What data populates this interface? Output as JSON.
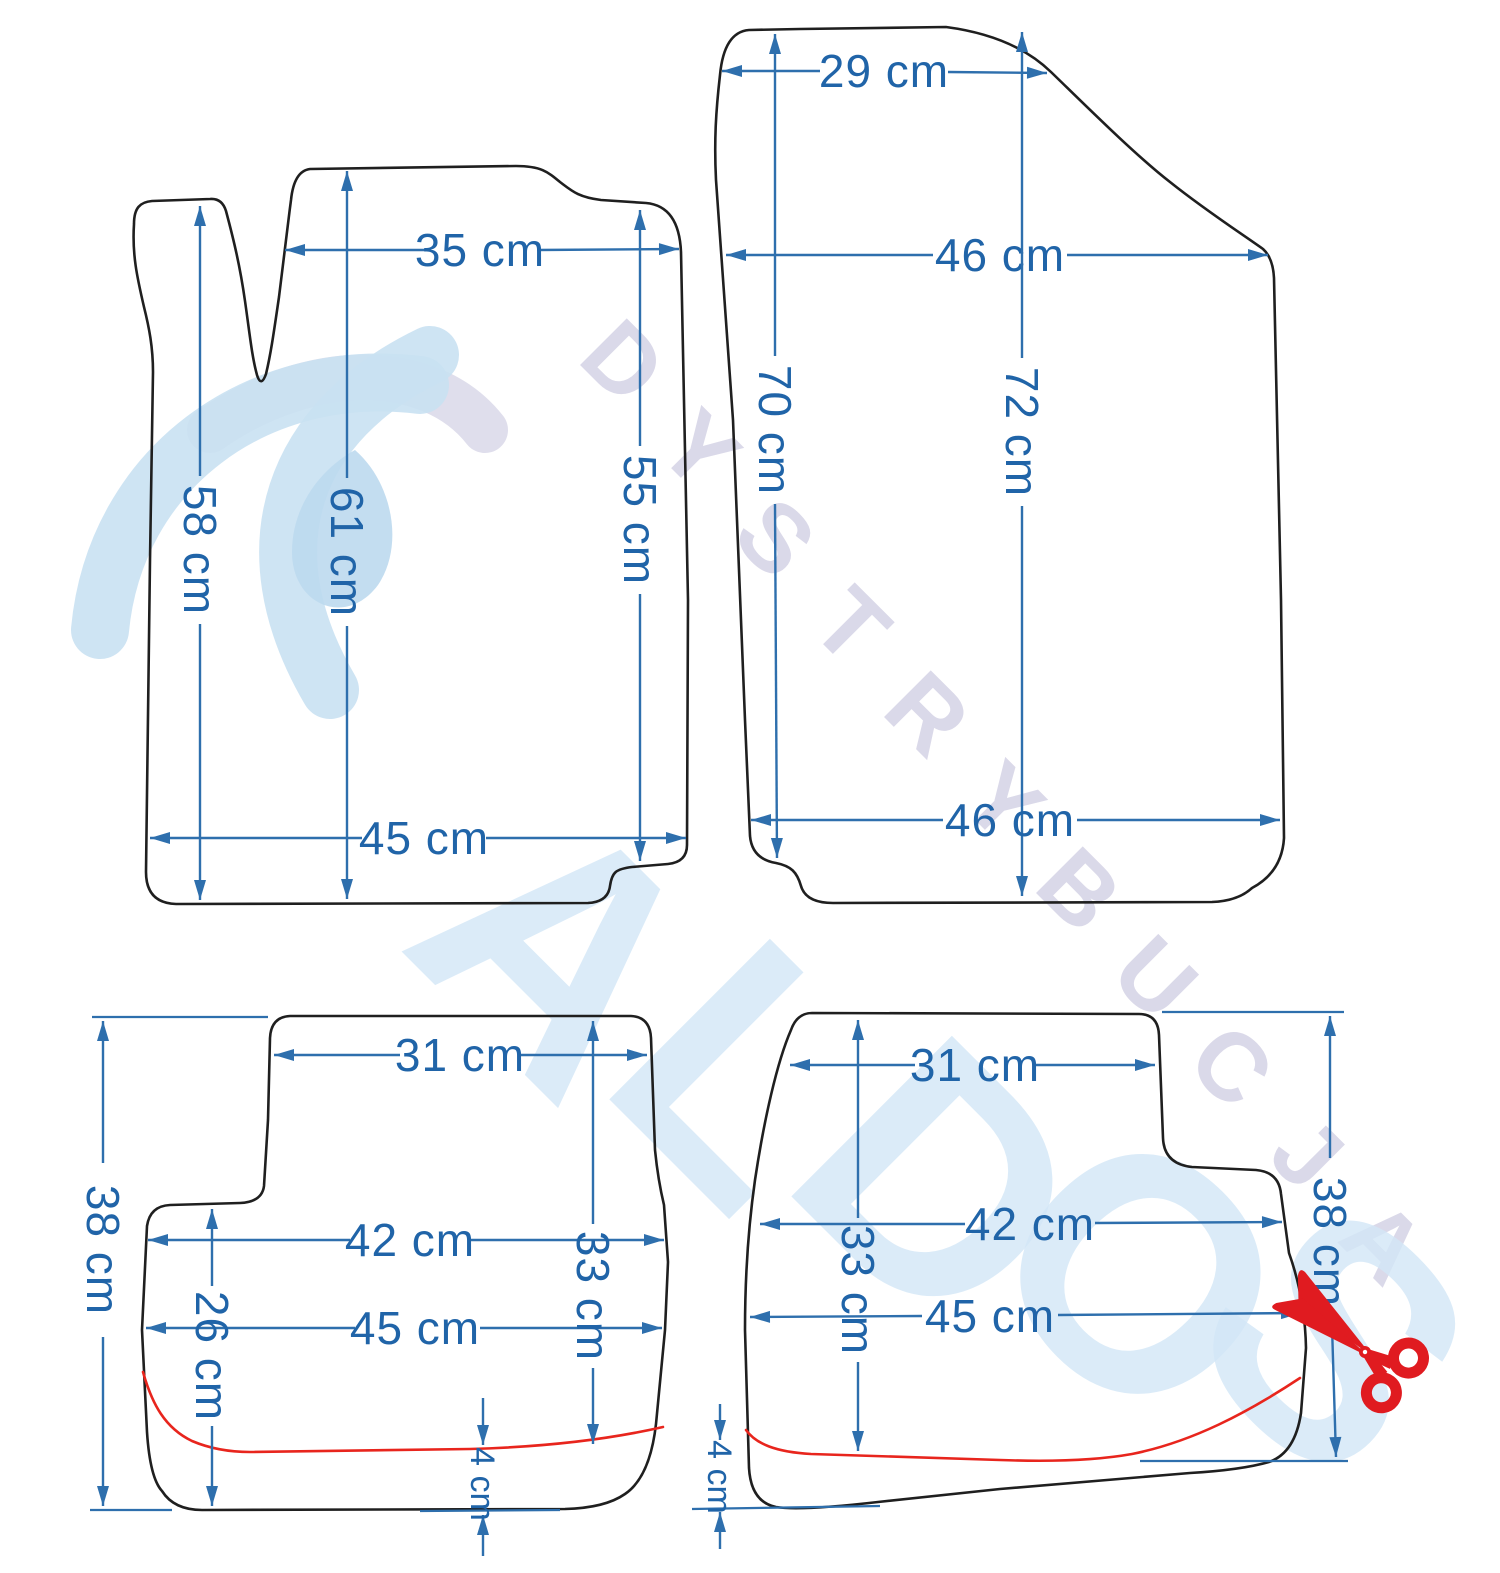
{
  "title": "car-floor-mat-dimensions-diagram",
  "colors": {
    "dimension_line": "#2e6fad",
    "dimension_text": "#2064a8",
    "mat_outline": "#1f1f1f",
    "cut_line": "#e8251d",
    "scissors": "#e01b20",
    "watermark_blue": "#d3e7f7",
    "watermark_lavender": "#d9d7e8"
  },
  "watermark": {
    "diagonal_text": "DYSTRYBUCJA",
    "diagonal_letters": [
      "D",
      "Y",
      "S",
      "T",
      "R",
      "Y",
      "B",
      "U",
      "C",
      "J",
      "A"
    ],
    "brand_text": "ALDOS",
    "brand_letters": [
      "A",
      "L",
      "D",
      "O",
      "S"
    ]
  },
  "mats": {
    "front_left": {
      "label": "front-left-mat",
      "dims": {
        "top_width": "35 cm",
        "left_height": "58 cm",
        "center_height": "61 cm",
        "right_height": "55 cm",
        "bottom_width": "45 cm"
      }
    },
    "front_right": {
      "label": "front-right-mat",
      "dims": {
        "top_width": "29 cm",
        "upper_width": "46 cm",
        "left_height": "70 cm",
        "right_height": "72 cm",
        "bottom_width": "46 cm"
      }
    },
    "rear_left": {
      "label": "rear-left-mat",
      "dims": {
        "top_width": "31 cm",
        "mid_width": "42 cm",
        "bottom_width": "45 cm",
        "total_height": "38 cm",
        "front_height": "26 cm",
        "back_height": "33 cm",
        "cut_gap": "4 cm"
      }
    },
    "rear_right": {
      "label": "rear-right-mat",
      "dims": {
        "top_width": "31 cm",
        "back_height": "33 cm",
        "mid_width": "42 cm",
        "bottom_width": "45 cm",
        "total_height": "38 cm",
        "cut_gap": "4 cm"
      }
    }
  }
}
